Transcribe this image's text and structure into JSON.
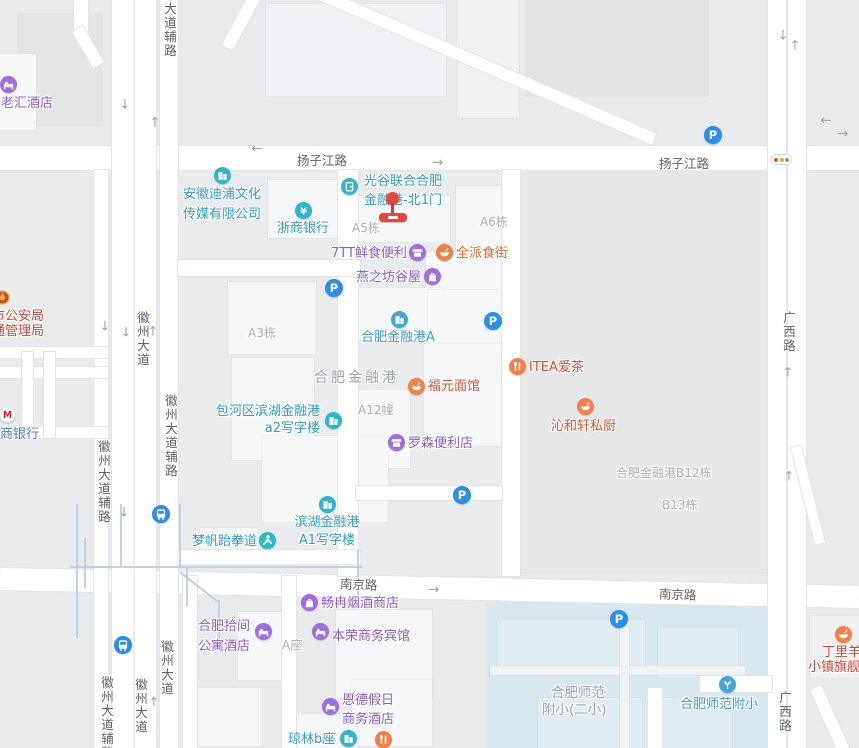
{
  "map": {
    "colors": {
      "background": "#e9eaec",
      "water": "#d9e7ee",
      "building": "#f6f7f9",
      "road": "#ffffff",
      "road_casing": "#e3e4e6",
      "stream": "#bcd2e8",
      "road_label": "#5d6268",
      "area_label": "#a9afb7",
      "parking_blue": "#2a8fe8",
      "marker_red": "#e8453c"
    },
    "geometry": {
      "water": {
        "x": 487,
        "y": 596,
        "w": 285,
        "h": 152
      },
      "blocks": [
        {
          "x": 178,
          "y": 170,
          "w": 342,
          "h": 406,
          "c": "#eaebec"
        },
        {
          "x": 520,
          "y": 170,
          "w": 252,
          "h": 402,
          "c": "#e6e7e9"
        },
        {
          "x": 18,
          "y": 14,
          "w": 84,
          "h": 112,
          "c": "#e4e5e7"
        },
        {
          "x": 526,
          "y": 0,
          "w": 182,
          "h": 96,
          "c": "#e3e4e6"
        },
        {
          "x": 0,
          "y": 54,
          "w": 36,
          "h": 76
        },
        {
          "x": 266,
          "y": 4,
          "w": 180,
          "h": 92,
          "c": "#f0f1f4"
        },
        {
          "x": 457,
          "y": 0,
          "w": 62,
          "h": 118,
          "c": "#eef0f2"
        },
        {
          "x": 268,
          "y": 180,
          "w": 78,
          "h": 58
        },
        {
          "x": 358,
          "y": 196,
          "w": 92,
          "h": 46
        },
        {
          "x": 456,
          "y": 186,
          "w": 60,
          "h": 90
        },
        {
          "x": 426,
          "y": 252,
          "w": 84,
          "h": 54
        },
        {
          "x": 228,
          "y": 282,
          "w": 88,
          "h": 72
        },
        {
          "x": 354,
          "y": 288,
          "w": 90,
          "h": 52
        },
        {
          "x": 428,
          "y": 290,
          "w": 78,
          "h": 92
        },
        {
          "x": 348,
          "y": 390,
          "w": 62,
          "h": 78
        },
        {
          "x": 424,
          "y": 344,
          "w": 84,
          "h": 102
        },
        {
          "x": 232,
          "y": 358,
          "w": 82,
          "h": 102
        },
        {
          "x": 262,
          "y": 436,
          "w": 126,
          "h": 86
        },
        {
          "x": 200,
          "y": 528,
          "w": 58,
          "h": 34
        },
        {
          "x": 336,
          "y": 610,
          "w": 96,
          "h": 88
        },
        {
          "x": 238,
          "y": 612,
          "w": 58,
          "h": 68
        },
        {
          "x": 352,
          "y": 680,
          "w": 80,
          "h": 66
        },
        {
          "x": 286,
          "y": 714,
          "w": 72,
          "h": 34
        },
        {
          "x": 198,
          "y": 688,
          "w": 64,
          "h": 58
        },
        {
          "x": 810,
          "y": 616,
          "w": 49,
          "h": 62,
          "c": "#edeff1"
        },
        {
          "x": 497,
          "y": 620,
          "w": 148,
          "h": 46,
          "c": "#e1ecf1"
        },
        {
          "x": 658,
          "y": 628,
          "w": 80,
          "h": 50,
          "c": "#e1ecf1"
        },
        {
          "x": 538,
          "y": 698,
          "w": 104,
          "h": 50,
          "c": "#e1ecf1"
        },
        {
          "x": 660,
          "y": 698,
          "w": 72,
          "h": 50,
          "c": "#e1ecf1"
        },
        {
          "x": 490,
          "y": 666,
          "w": 255,
          "h": 9,
          "c": "#edf3f6"
        },
        {
          "x": 620,
          "y": 620,
          "w": 9,
          "h": 128,
          "c": "#edf3f6"
        }
      ],
      "roads": [
        {
          "x": 0,
          "y": 146,
          "w": 859,
          "h": 24
        },
        {
          "x": 0,
          "y": 577,
          "w": 859,
          "h": 22,
          "a": 1.2
        },
        {
          "x": 112,
          "y": 0,
          "w": 44,
          "h": 748
        },
        {
          "x": 160,
          "y": 0,
          "w": 18,
          "h": 748
        },
        {
          "x": 94,
          "y": 170,
          "w": 14,
          "h": 578
        },
        {
          "x": 768,
          "y": 0,
          "w": 18,
          "h": 748
        },
        {
          "x": 788,
          "y": 0,
          "w": 18,
          "h": 748
        },
        {
          "x": 338,
          "y": 170,
          "w": 20,
          "h": 406
        },
        {
          "x": 502,
          "y": 170,
          "w": 18,
          "h": 406
        },
        {
          "x": 178,
          "y": 260,
          "w": 182,
          "h": 16
        },
        {
          "x": 178,
          "y": 550,
          "w": 182,
          "h": 14
        },
        {
          "x": 356,
          "y": 486,
          "w": 146,
          "h": 14
        },
        {
          "x": 307,
          "y": 61,
          "w": 362,
          "h": 12,
          "a": 23.5
        },
        {
          "x": 235,
          "y": -7,
          "w": 12,
          "h": 58,
          "a": 28
        },
        {
          "x": 74,
          "y": 0,
          "w": 14,
          "h": 38
        },
        {
          "x": 82,
          "y": 26,
          "w": 12,
          "h": 42,
          "a": -30
        },
        {
          "x": 0,
          "y": 347,
          "w": 108,
          "h": 11
        },
        {
          "x": 0,
          "y": 367,
          "w": 108,
          "h": 11
        },
        {
          "x": 0,
          "y": 427,
          "w": 108,
          "h": 11
        },
        {
          "x": 22,
          "y": 352,
          "w": 11,
          "h": 86
        },
        {
          "x": 44,
          "y": 352,
          "w": 11,
          "h": 86
        },
        {
          "x": 700,
          "y": 676,
          "w": 72,
          "h": 16
        },
        {
          "x": 648,
          "y": 688,
          "w": 14,
          "h": 60
        },
        {
          "x": 803,
          "y": 445,
          "w": 10,
          "h": 100,
          "a": -14
        },
        {
          "x": 826,
          "y": 684,
          "w": 12,
          "h": 80,
          "a": -24
        },
        {
          "x": 183,
          "y": 576,
          "w": 14,
          "h": 172
        },
        {
          "x": 282,
          "y": 576,
          "w": 14,
          "h": 172
        }
      ],
      "median": {
        "x": 133,
        "y": 0,
        "w": 2,
        "h": 748,
        "c": "#ececee"
      },
      "streams": [
        {
          "x": 70,
          "y": 566,
          "w": 292,
          "h": 2
        },
        {
          "x": 76,
          "y": 504,
          "w": 2,
          "h": 134
        },
        {
          "x": 84,
          "y": 538,
          "w": 2,
          "h": 50
        },
        {
          "x": 120,
          "y": 504,
          "w": 2,
          "h": 62
        },
        {
          "x": 179,
          "y": 504,
          "w": 2,
          "h": 62
        },
        {
          "x": 357,
          "y": 550,
          "w": 2,
          "h": 46
        },
        {
          "x": 186,
          "y": 566,
          "w": 2,
          "h": 40
        },
        {
          "x": 175,
          "y": 586,
          "w": 48,
          "h": 2,
          "a": 38
        },
        {
          "x": 218,
          "y": 600,
          "w": 2,
          "h": 46
        }
      ]
    },
    "road_labels": [
      {
        "text": "扬子江路",
        "x": 297,
        "y": 150
      },
      {
        "text": "扬子江路",
        "x": 659,
        "y": 153
      },
      {
        "text": "南京路",
        "x": 340,
        "y": 574,
        "a": 2
      },
      {
        "text": "南京路",
        "x": 659,
        "y": 584,
        "a": 2
      },
      {
        "text": "广西路",
        "x": 779,
        "y": 311,
        "v": true
      },
      {
        "text": "广西路",
        "x": 775,
        "y": 691,
        "v": true
      },
      {
        "text": "徽州大道",
        "x": 133,
        "y": 311,
        "v": true
      },
      {
        "text": "徽州大道辅路",
        "x": 161,
        "y": 394,
        "v": true
      },
      {
        "text": "徽州大道辅路",
        "x": 94,
        "y": 440,
        "v": true
      },
      {
        "text": "大道辅路",
        "x": 160,
        "y": 2,
        "v": true
      },
      {
        "text": "徽州大道辅路",
        "x": 97,
        "y": 676,
        "v": true
      },
      {
        "text": "徽州大道",
        "x": 131,
        "y": 678,
        "v": true
      },
      {
        "text": "徽州大道",
        "x": 157,
        "y": 640,
        "v": true
      }
    ],
    "area_labels": [
      {
        "text": "A5栋",
        "x": 352,
        "y": 219
      },
      {
        "text": "A6栋",
        "x": 480,
        "y": 213
      },
      {
        "text": "A3栋",
        "x": 248,
        "y": 324
      },
      {
        "text": "A12幢",
        "x": 358,
        "y": 401
      },
      {
        "text": "合肥金融港",
        "x": 314,
        "y": 367,
        "s": 14,
        "sp": 3,
        "c": "#9ba3ab"
      },
      {
        "text": "合肥金融港B12栋",
        "x": 616,
        "y": 464
      },
      {
        "text": "B13栋",
        "x": 662,
        "y": 496
      },
      {
        "text": "A座",
        "x": 282,
        "y": 636
      },
      {
        "text": "合肥师范",
        "x": 551,
        "y": 681,
        "s": 13.5,
        "c": "#98a0a8"
      },
      {
        "text": "附小(二小)",
        "x": 542,
        "y": 698,
        "s": 13.5,
        "c": "#98a0a8"
      }
    ],
    "pois": [
      {
        "id": "laohui-hotel",
        "icon": {
          "x": 8,
          "y": 84,
          "g": "bed",
          "c": "#a06ce0"
        },
        "label": {
          "x": 1,
          "y": 96,
          "lines": [
            "老汇酒店"
          ],
          "c": "#8a5bd6"
        }
      },
      {
        "id": "police-bureau",
        "icon": {
          "x": 2,
          "y": 297,
          "g": "badge",
          "c": "transparent"
        },
        "label": {
          "x": -8,
          "y": 310,
          "lines": [
            "市公安局",
            "通管理局"
          ],
          "c": "#d24535",
          "lh": 14.5
        }
      },
      {
        "id": "cmb-bank",
        "icon": {
          "x": 7,
          "y": 414,
          "g": "cmb",
          "c": "#ffffff"
        },
        "label": {
          "x": -13,
          "y": 427,
          "lines": [
            "招商银行"
          ],
          "c": "#4a7ec7"
        }
      },
      {
        "id": "anhui-dipu-culture",
        "icon": {
          "x": 222,
          "y": 175,
          "g": "building",
          "c": "#2eb6ca"
        },
        "label": {
          "x": 183,
          "y": 185,
          "lines": [
            "安徽迪浦文化",
            "传媒有限公司"
          ],
          "c": "#2f9cc9",
          "lh": 19.5
        }
      },
      {
        "id": "zheshang-bank",
        "icon": {
          "x": 303,
          "y": 210,
          "g": "yen",
          "c": "#2eb6ca"
        },
        "label": {
          "x": 277,
          "y": 221,
          "lines": [
            "浙商银行"
          ],
          "c": "#2f9cc9"
        }
      },
      {
        "id": "guanggu-north-gate-1",
        "icon": {
          "x": 349,
          "y": 186,
          "g": "door",
          "c": "#2eb6ca"
        },
        "label": {
          "x": 364,
          "y": 172,
          "lines": [
            "光谷联合合肥",
            "金融港-北1门"
          ],
          "c": "#2f9cc9",
          "lh": 19
        }
      },
      {
        "id": "7tt-fresh-food",
        "icon": {
          "x": 417,
          "y": 252,
          "g": "shop",
          "c": "#a06ce0"
        },
        "label": {
          "x": 331,
          "y": 246,
          "lines": [
            "7TT鲜食便利"
          ],
          "c": "#8a5bd6"
        }
      },
      {
        "id": "quanpai-food-street",
        "icon": {
          "x": 444,
          "y": 252,
          "g": "bowl",
          "c": "#f28048"
        },
        "label": {
          "x": 456,
          "y": 246,
          "lines": [
            "全派食街"
          ],
          "c": "#e2661f"
        }
      },
      {
        "id": "yanzhifang-guwu",
        "icon": {
          "x": 432,
          "y": 276,
          "g": "bag",
          "c": "#a06ce0"
        },
        "label": {
          "x": 356,
          "y": 270,
          "lines": [
            "燕之坊谷屋"
          ],
          "c": "#8a5bd6"
        }
      },
      {
        "id": "hefei-financial-port-a",
        "icon": {
          "x": 399,
          "y": 319,
          "g": "building",
          "c": "#41a6de"
        },
        "label": {
          "x": 361,
          "y": 330,
          "lines": [
            "合肥金融港A"
          ],
          "c": "#3e9bd9"
        }
      },
      {
        "id": "fuyuan-noodle",
        "icon": {
          "x": 416,
          "y": 386,
          "g": "bowl",
          "c": "#f28048"
        },
        "label": {
          "x": 428,
          "y": 379,
          "lines": [
            "福元面馆"
          ],
          "c": "#d7502f"
        }
      },
      {
        "id": "itea-tea",
        "icon": {
          "x": 517,
          "y": 366,
          "g": "forkknife",
          "c": "#f28048"
        },
        "label": {
          "x": 529,
          "y": 360,
          "lines": [
            "ITEA爱茶"
          ],
          "c": "#d7502f"
        }
      },
      {
        "id": "qinhexuan-kitchen",
        "icon": {
          "x": 585,
          "y": 406,
          "g": "bowl",
          "c": "#f28048"
        },
        "label": {
          "x": 551,
          "y": 419,
          "lines": [
            "沁和轩私厨"
          ],
          "c": "#d7502f"
        }
      },
      {
        "id": "baohe-a2-office",
        "icon": {
          "x": 333,
          "y": 420,
          "g": "building",
          "c": "#2eb6ca"
        },
        "label": {
          "x": 214,
          "y": 403,
          "lines": [
            "包河区滨湖金融港",
            "a2写字楼"
          ],
          "c": "#2f9cc9",
          "w": 106,
          "align": "right",
          "lh": 17
        }
      },
      {
        "id": "lawson-store",
        "icon": {
          "x": 396,
          "y": 442,
          "g": "shop",
          "c": "#a06ce0"
        },
        "label": {
          "x": 408,
          "y": 436,
          "lines": [
            "罗森便利店"
          ],
          "c": "#8a5bd6"
        }
      },
      {
        "id": "mengfan-taekwondo",
        "icon": {
          "x": 267,
          "y": 540,
          "g": "person",
          "c": "#2eb6ca"
        },
        "label": {
          "x": 192,
          "y": 534,
          "lines": [
            "梦帆跆拳道"
          ],
          "c": "#2f9cc9"
        }
      },
      {
        "id": "binhu-a1-office",
        "icon": {
          "x": 327,
          "y": 504,
          "g": "building",
          "c": "#2eb6ca"
        },
        "label": {
          "x": 291,
          "y": 514,
          "lines": [
            "滨湖金融港",
            "A1写字楼"
          ],
          "c": "#2f9cc9",
          "w": 72,
          "align": "center",
          "lh": 18
        }
      },
      {
        "id": "changran-tobacco",
        "icon": {
          "x": 309,
          "y": 602,
          "g": "bag",
          "c": "#a06ce0"
        },
        "label": {
          "x": 321,
          "y": 596,
          "lines": [
            "畅冉烟酒商店"
          ],
          "c": "#8a5bd6"
        }
      },
      {
        "id": "shijian-apartment-hotel",
        "icon": {
          "x": 263,
          "y": 631,
          "g": "bed",
          "c": "#a06ce0"
        },
        "label": {
          "x": 188,
          "y": 617,
          "lines": [
            "合肥拾间",
            "公寓酒店"
          ],
          "c": "#8a5bd6",
          "w": 62,
          "align": "right",
          "lh": 20
        }
      },
      {
        "id": "benrong-hotel",
        "icon": {
          "x": 320,
          "y": 631,
          "g": "bed",
          "c": "#a06ce0"
        },
        "label": {
          "x": 332,
          "y": 629,
          "lines": [
            "本荣商务宾馆"
          ],
          "c": "#8a5bd6"
        }
      },
      {
        "id": "ende-holiday-hotel",
        "icon": {
          "x": 330,
          "y": 706,
          "g": "bed",
          "c": "#a06ce0"
        },
        "label": {
          "x": 342,
          "y": 691,
          "lines": [
            "恩德假日",
            "商务酒店"
          ],
          "c": "#8a5bd6",
          "lh": 19
        }
      },
      {
        "id": "qionglin-b",
        "icon": {
          "x": 348,
          "y": 738,
          "g": "building",
          "c": "#2eb6ca"
        },
        "label": {
          "x": 288,
          "y": 732,
          "lines": [
            "琼林b座"
          ],
          "c": "#2f9cc9"
        }
      },
      {
        "id": "food-poi-bottom",
        "icon": {
          "x": 383,
          "y": 739,
          "g": "forkknife",
          "c": "#f28048"
        }
      },
      {
        "id": "shifan-primary-school",
        "icon": {
          "x": 727,
          "y": 684,
          "g": "sprout",
          "c": "#41a6de"
        },
        "label": {
          "x": 680,
          "y": 697,
          "lines": [
            "合肥师范附小"
          ],
          "c": "#3e9bd9"
        }
      },
      {
        "id": "dingliyang-flagship",
        "icon": {
          "x": 843,
          "y": 634,
          "g": "bowl",
          "c": "#f28048"
        },
        "label": {
          "x": 808,
          "y": 645,
          "lines": [
            {
              "t": "丁里羊",
              "dx": 14
            },
            {
              "t": "小镇旗舰店",
              "dx": 0
            }
          ],
          "c": "#d24535",
          "lh": 15
        }
      }
    ],
    "parking": [
      {
        "x": 713,
        "y": 135
      },
      {
        "x": 334,
        "y": 288
      },
      {
        "x": 493,
        "y": 321
      },
      {
        "x": 462,
        "y": 495
      },
      {
        "x": 619,
        "y": 619
      }
    ],
    "bus_stations": [
      {
        "x": 161,
        "y": 514
      },
      {
        "x": 123,
        "y": 645
      }
    ],
    "traffic_light": {
      "x": 771,
      "y": 154
    },
    "marker": {
      "head_x": 386,
      "head_y": 192,
      "bar_x": 379,
      "bar_y": 213
    },
    "arrows": [
      {
        "x": 257,
        "y": 149,
        "d": "←"
      },
      {
        "x": 438,
        "y": 163,
        "d": "→"
      },
      {
        "x": 826,
        "y": 121,
        "d": "←"
      },
      {
        "x": 843,
        "y": 134,
        "d": "→"
      },
      {
        "x": 125,
        "y": 105,
        "d": "↓"
      },
      {
        "x": 155,
        "y": 123,
        "d": "↑"
      },
      {
        "x": 105,
        "y": 327,
        "d": "↓"
      },
      {
        "x": 126,
        "y": 333,
        "d": "↓"
      },
      {
        "x": 153,
        "y": 332,
        "d": "↑"
      },
      {
        "x": 783,
        "y": 36,
        "d": "↓"
      },
      {
        "x": 795,
        "y": 46,
        "d": "↑"
      },
      {
        "x": 788,
        "y": 373,
        "d": "↑"
      },
      {
        "x": 789,
        "y": 477,
        "d": "↑"
      },
      {
        "x": 124,
        "y": 513,
        "d": "↓"
      },
      {
        "x": 434,
        "y": 590,
        "d": "→"
      },
      {
        "x": 154,
        "y": 703,
        "d": "↑"
      }
    ]
  }
}
